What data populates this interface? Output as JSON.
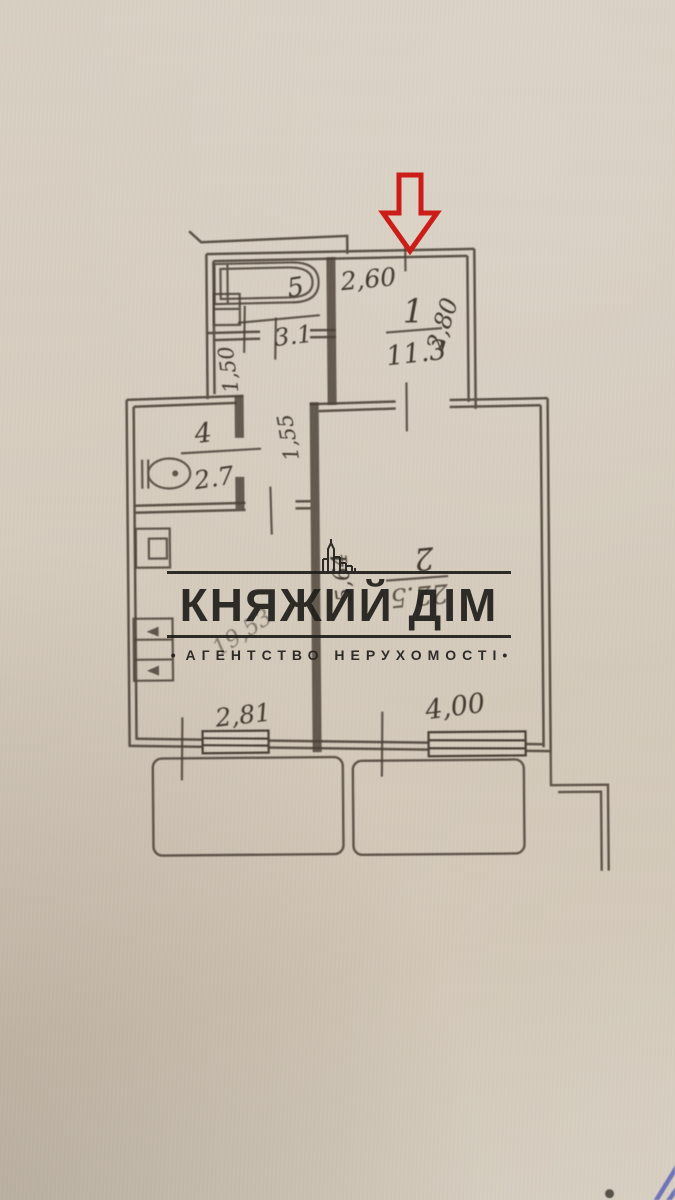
{
  "photo": {
    "paper_color": "#d6ccbe",
    "ink_color": "#4a4036",
    "arrow_color": "#cd1b16",
    "pen_color": "#5d63b8"
  },
  "agency_watermark": {
    "title": "КНЯЖИЙ ДІМ",
    "subtitle": "АГЕНТСТВО НЕРУХОМОСТІ",
    "bullet_left": "•",
    "bullet_right": "•",
    "logo": "building-skyline-icon"
  },
  "floor_plan": {
    "rooms": [
      {
        "id": "hall",
        "number": "1",
        "area": "11.3"
      },
      {
        "id": "living-room",
        "number": "2",
        "area": "22.5"
      },
      {
        "id": "toilet",
        "number": "4",
        "area": "2.7"
      },
      {
        "id": "bathroom",
        "number": "5",
        "area": "3.1"
      }
    ],
    "dimensions": {
      "top_width": "2,60",
      "hall_height": "2,80",
      "hall_width_upper": "1,50",
      "hall_width_lower": "1,55",
      "living_depth": "5,64",
      "kitchen_window_width": "2,81",
      "living_window_width": "4,00",
      "diagonal_note": "19,53"
    }
  }
}
